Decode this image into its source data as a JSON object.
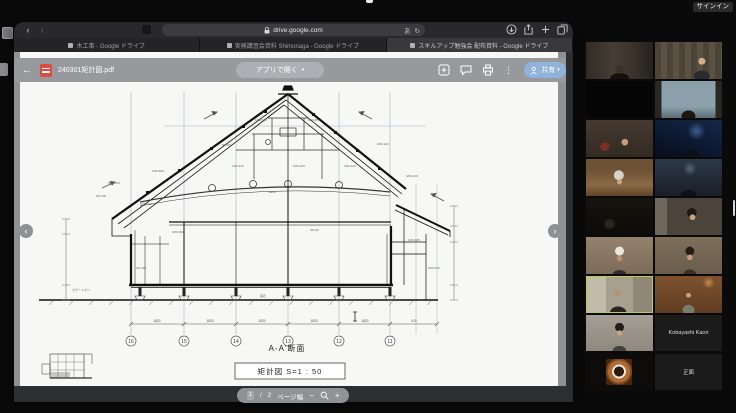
{
  "zoom_ui": {
    "signin_label": "サインイン",
    "active_speaker_border_color": "#b9cf52",
    "participants": [
      {
        "id": "p1",
        "label": "",
        "video": true
      },
      {
        "id": "p2",
        "label": "",
        "video": true
      },
      {
        "id": "p3",
        "label": "",
        "video": false
      },
      {
        "id": "p4",
        "label": "",
        "video": true
      },
      {
        "id": "p5",
        "label": "",
        "video": true
      },
      {
        "id": "p6",
        "label": "",
        "video": true
      },
      {
        "id": "p7",
        "label": "",
        "video": true
      },
      {
        "id": "p8",
        "label": "",
        "video": true
      },
      {
        "id": "p9",
        "label": "",
        "video": true
      },
      {
        "id": "p10",
        "label": "",
        "video": true
      },
      {
        "id": "p11",
        "label": "",
        "video": true
      },
      {
        "id": "p12",
        "label": "",
        "video": true
      },
      {
        "id": "p13",
        "label": "",
        "video": true,
        "active": true
      },
      {
        "id": "p14",
        "label": "",
        "video": true
      },
      {
        "id": "p15",
        "label": "",
        "video": true
      },
      {
        "id": "p16",
        "label": "Kobayashi Kaori",
        "video": false
      },
      {
        "id": "p17",
        "label": "",
        "video": false,
        "avatar": "coffee-cup-photo"
      },
      {
        "id": "p18",
        "label": "正面",
        "video": false
      }
    ]
  },
  "browser": {
    "url": "drive.google.com",
    "lang_badge": "あ",
    "reload_glyph": "↻",
    "back_glyph": "‹",
    "forward_glyph": "›",
    "tabs": [
      {
        "title": "木工事 - Google ドライブ",
        "active": false
      },
      {
        "title": "実務講習会資料 Shimonaga - Google ドライブ",
        "active": false
      },
      {
        "title": "スキルアップ勉強会 配布資料 - Google ドライブ",
        "active": true
      }
    ]
  },
  "drive_viewer": {
    "back_glyph": "←",
    "filename": "240301矩計図.pdf",
    "open_with_label": "アプリで開く",
    "share_label": "共有",
    "share_button_color": "#8fb3da",
    "caret_glyph": "▾",
    "more_glyph": "⋮",
    "prev_glyph": "‹",
    "next_glyph": "›",
    "page_current": "1",
    "page_separator": "/",
    "page_total": "2",
    "fit_label": "ページ幅",
    "zoom_out_glyph": "−",
    "zoom_in_glyph": "+"
  },
  "drawing": {
    "title": "A-A′断面",
    "scale_label": "矩計図  S=1 : 50",
    "grid_labels": [
      "16",
      "15",
      "14",
      "13",
      "12",
      "11"
    ],
    "dim_labels": [
      "1820",
      "1820",
      "1820",
      "1820",
      "1820",
      "910"
    ],
    "size_labels": [
      "105×180",
      "105×105",
      "30×105",
      "90×90",
      "105×105",
      "120×45",
      "120×120",
      "105×120",
      "120×120",
      "105×120",
      "105×120",
      "⌀250",
      "105×210",
      "105×300",
      "45×90",
      "105×105",
      "30×120",
      "105×120",
      "カラートタン",
      "束石"
    ]
  }
}
